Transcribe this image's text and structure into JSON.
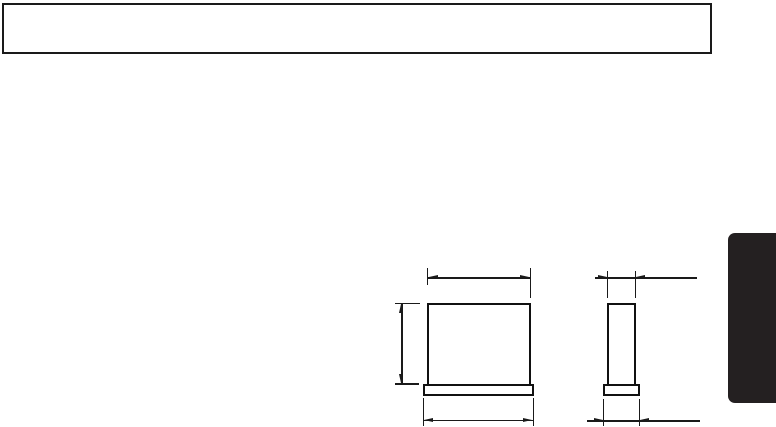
{
  "page": {
    "background_color": "#ffffff"
  },
  "colors": {
    "background": "#ffffff",
    "line": "#1a1a1a",
    "part_outline": "#111111",
    "tab": "#242021"
  },
  "header_box": {
    "content": ""
  },
  "drawing": {
    "type": "dimensioned-part-drawing",
    "views": [
      {
        "name": "front-view",
        "parts": [
          "body",
          "base-flange"
        ],
        "dimension_marks": [
          "body-width",
          "body-height",
          "base-width"
        ]
      },
      {
        "name": "side-view",
        "parts": [
          "body",
          "base-flange"
        ],
        "dimension_marks": [
          "body-depth",
          "base-depth"
        ]
      }
    ]
  },
  "side_tab": {
    "content": ""
  }
}
